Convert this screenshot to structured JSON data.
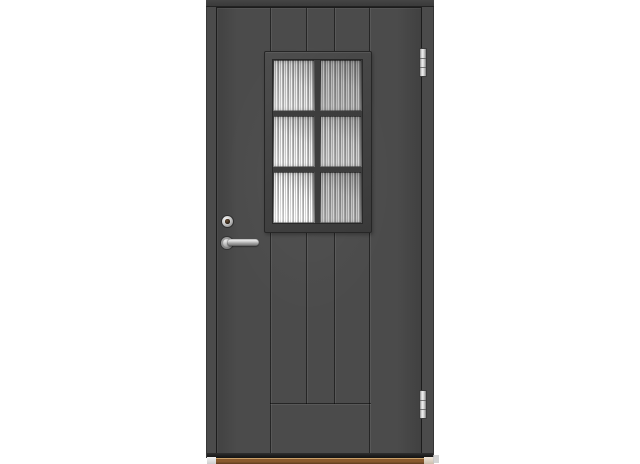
{
  "scene": {
    "description": "Product photo of a dark grey exterior front door with a six-pane obscure-glass window, chrome lever handle and lock cylinder on the left stile, two chrome hinges on the right edge, vertical plank grooves and a wooden threshold, shown on a plain white background",
    "object": "exterior-door",
    "visible_text": ""
  },
  "colors": {
    "background": "#ffffff",
    "door": "#4b4b4b",
    "frame_top": "#3a3a3a",
    "gap_line": "#1c1c1c",
    "window_frame": "#424242",
    "muntin": "#3d3d3d",
    "glass_light": "#e3e3e3",
    "glass_mid": "#b4b4b4",
    "glass_dark": "#8f8f8f",
    "hinge": "#d6d6d6",
    "hardware": "#c9c9c9",
    "keyhole": "#2a1f15",
    "threshold_wood": "#8a5a2e",
    "threshold_wood_dark": "#5f3d1d",
    "threshold_highlight": "#c99f68"
  },
  "door": {
    "window_grid": "2x3",
    "hinge_count": 2,
    "groove_count": 4,
    "panes": [
      {
        "id": "top-left",
        "brightness": 1.0
      },
      {
        "id": "top-right",
        "brightness": 0.82
      },
      {
        "id": "middle-left",
        "brightness": 1.04
      },
      {
        "id": "middle-right",
        "brightness": 0.9
      },
      {
        "id": "bottom-left",
        "brightness": 1.12
      },
      {
        "id": "bottom-right",
        "brightness": 0.86
      }
    ]
  }
}
